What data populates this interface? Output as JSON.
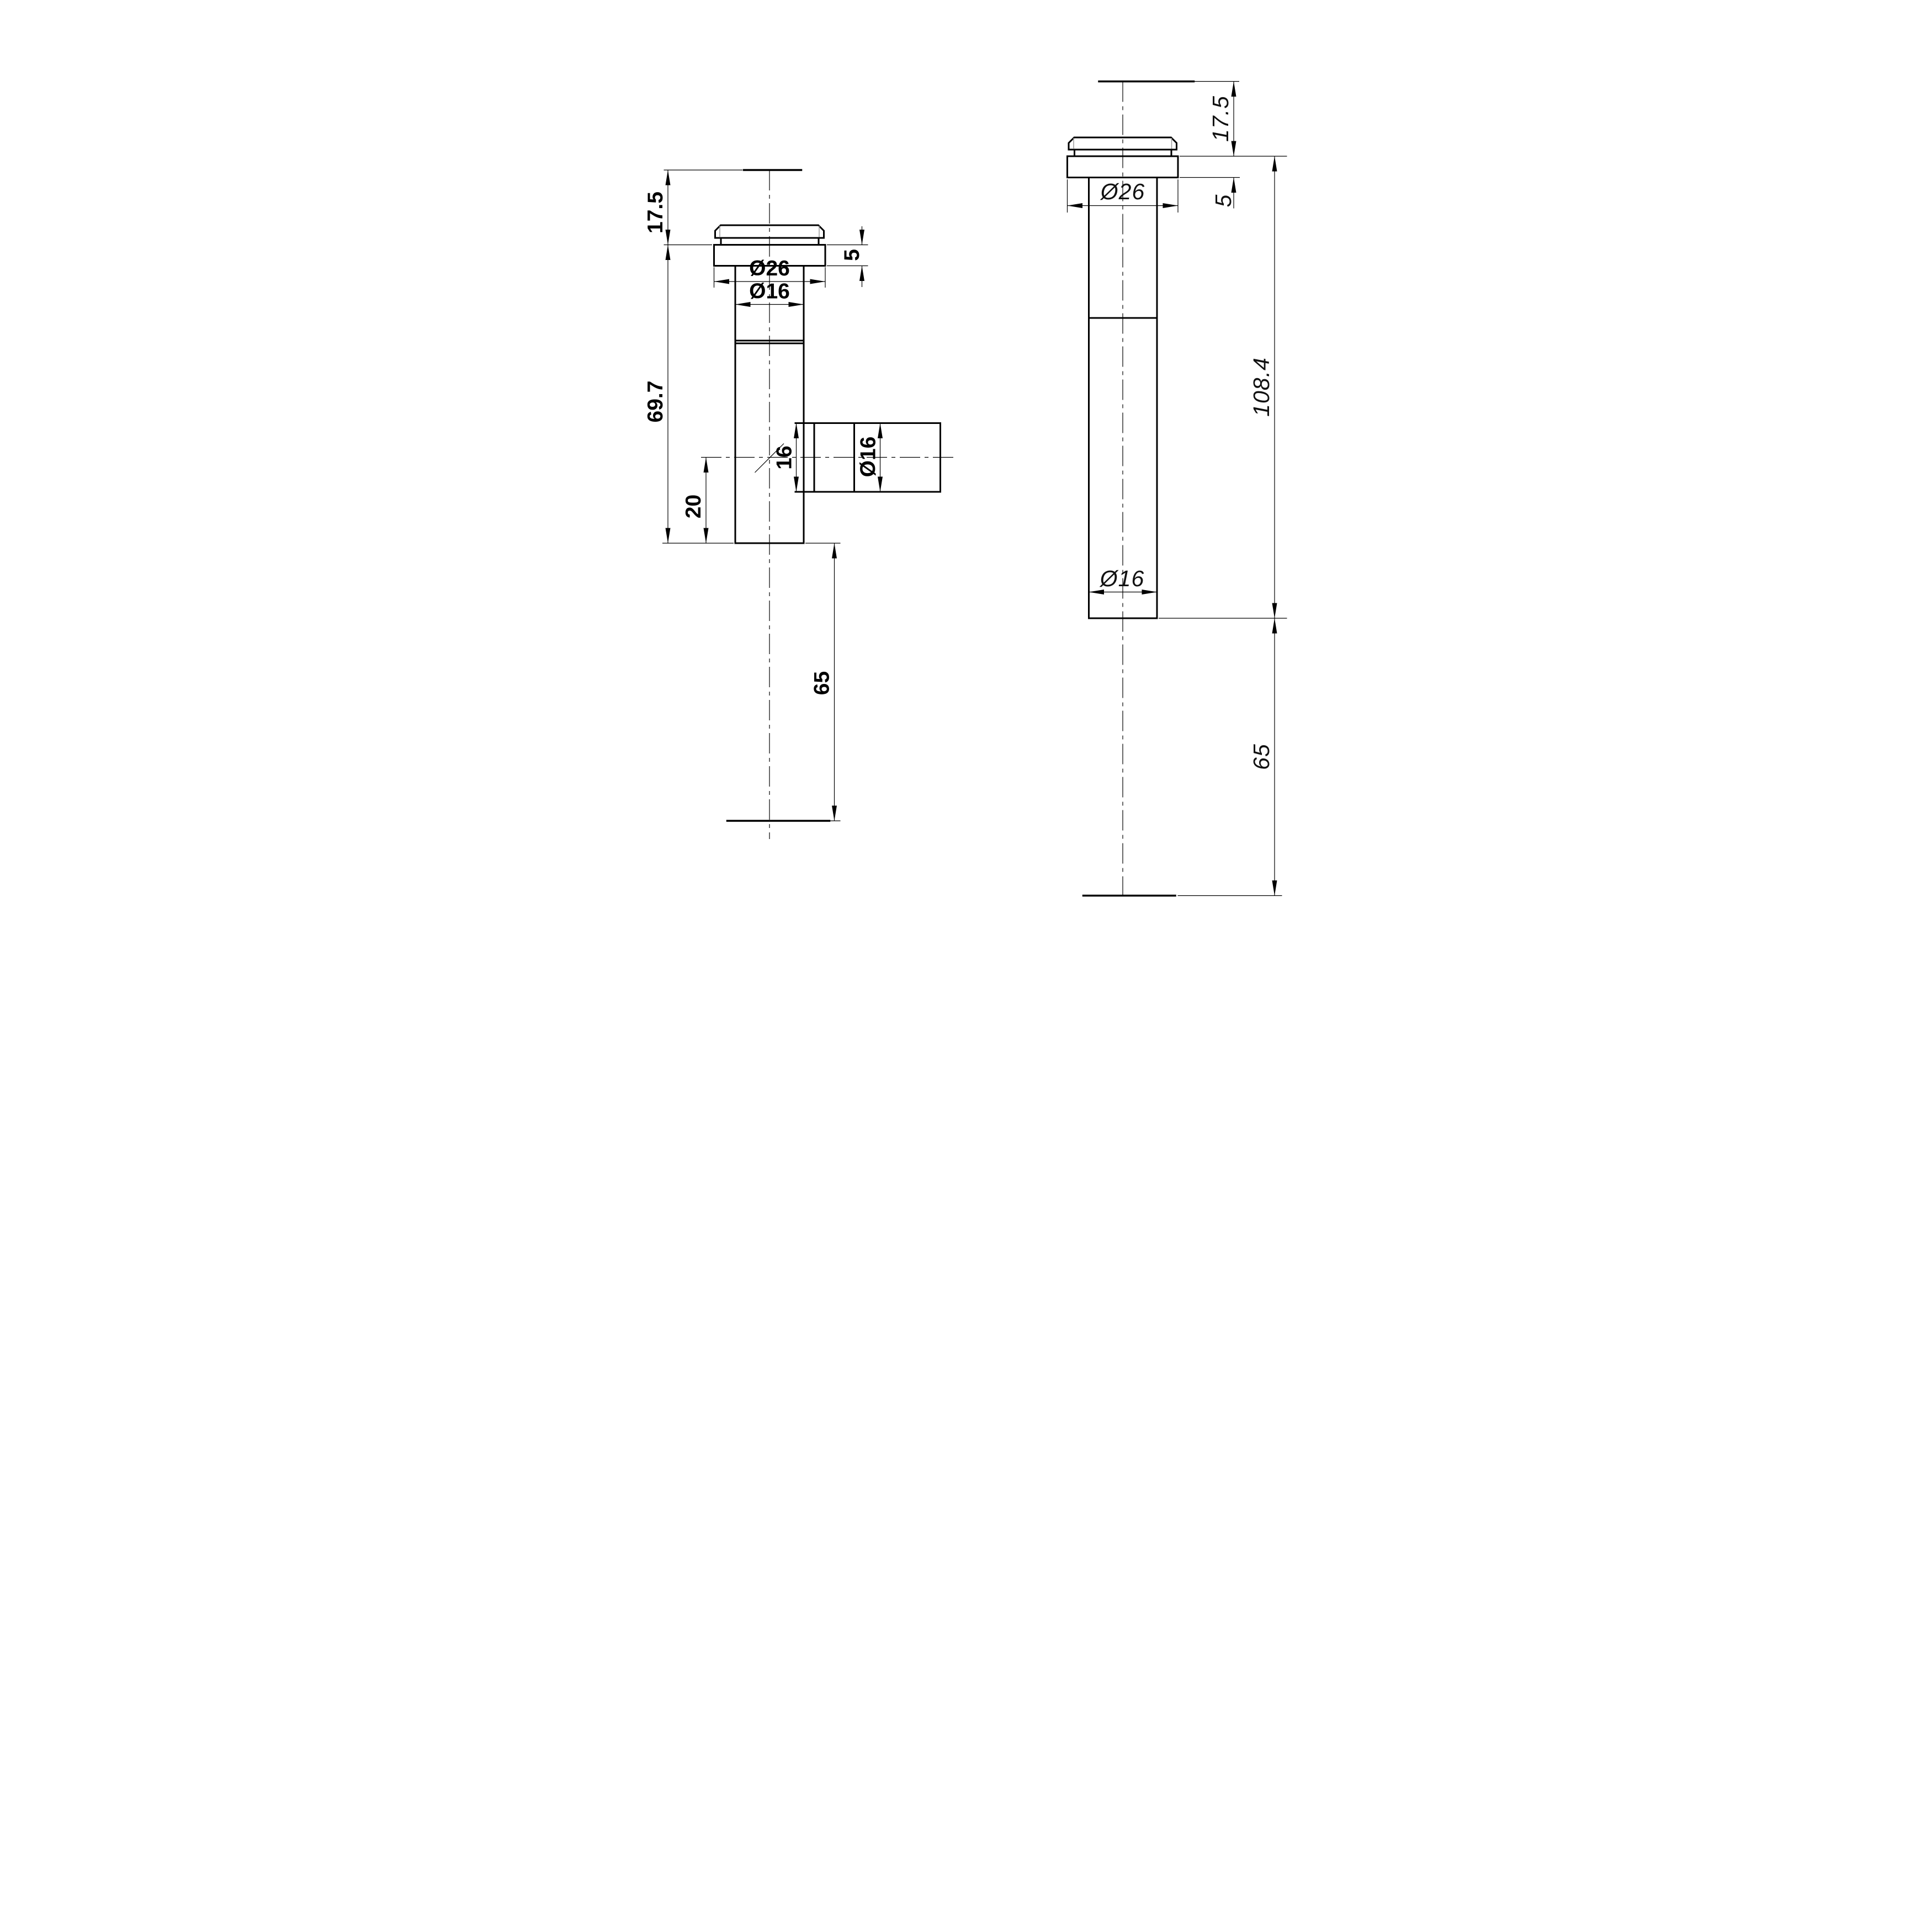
{
  "drawing": {
    "kind": "2D engineering drawing, two orthographic views of a cylindrical spout fitting",
    "background_color": "#ffffff",
    "line_color": "#000000",
    "views": {
      "left": {
        "description": "side view with lateral branch outlet",
        "dims": {
          "top_height": "17.5",
          "body_length": "69.7",
          "branch_offset": "20",
          "tail_length": "65",
          "collar_diameter": "Ø26",
          "shaft_diameter": "Ø16",
          "branch_bore": "16",
          "branch_diameter": "Ø16",
          "collar_height": "5"
        }
      },
      "right": {
        "description": "side view, straight body",
        "dims": {
          "top_height": "17.5",
          "collar_height": "5",
          "collar_diameter": "Ø26",
          "overall_length": "108.4",
          "shaft_diameter": "Ø16",
          "tail_length": "65"
        }
      }
    }
  }
}
